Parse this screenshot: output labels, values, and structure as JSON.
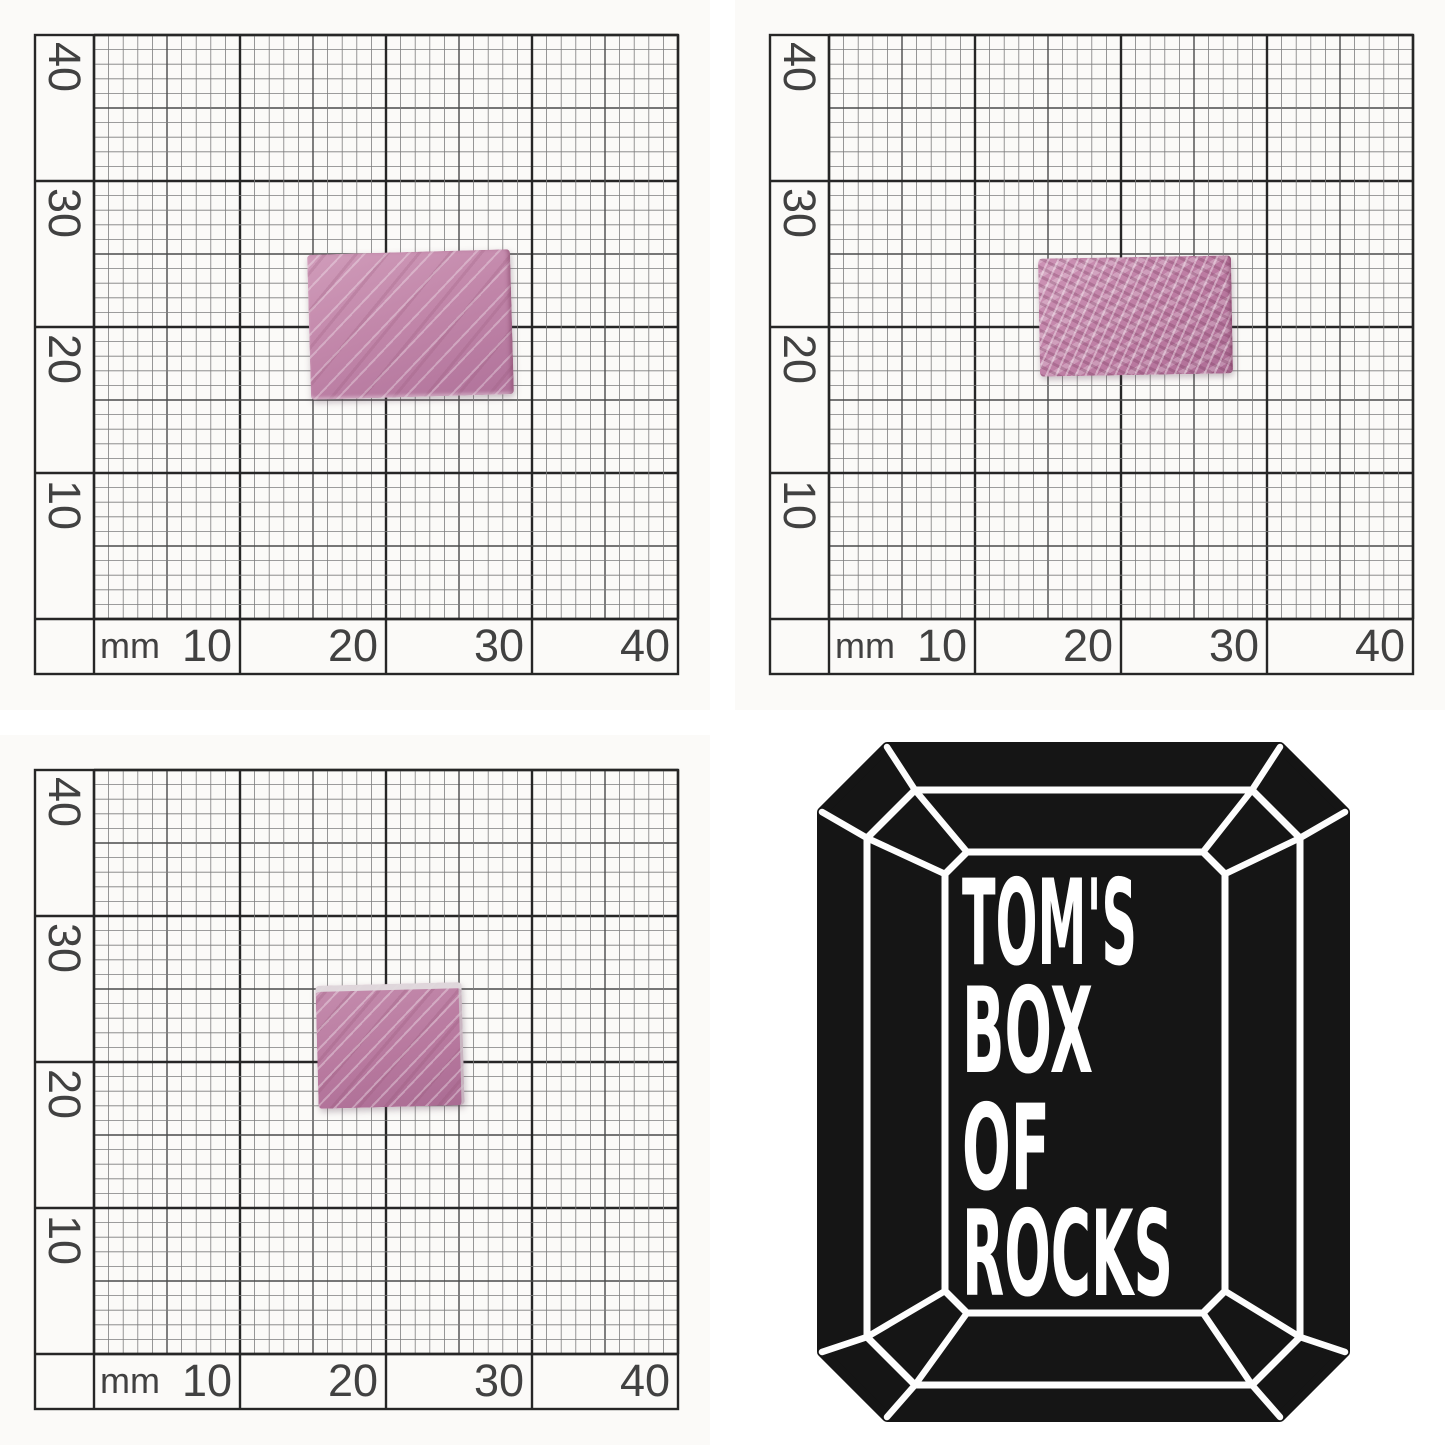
{
  "paper": {
    "unit_label": "mm",
    "y_axis_labels": [
      "40",
      "30",
      "20",
      "10"
    ],
    "x_axis_labels": [
      "10",
      "20",
      "30",
      "40"
    ],
    "paper_color": "#fbfaf8",
    "grid_major_color": "#262626",
    "grid_medium_color": "#4a4a4a",
    "grid_fine_color": "#7d7d7d",
    "label_color": "#414141"
  },
  "specimens": {
    "rock_base_color": "#c287aa",
    "rock_dark_color": "#aa6c93",
    "rock_streak_color": "#e7c6da"
  },
  "logo": {
    "icon": "emerald-cut-gem-icon",
    "lines": [
      "TOM'S",
      "BOX",
      "OF",
      "ROCKS"
    ],
    "gem_color": "#151515",
    "line_color": "#ffffff",
    "text_color": "#ffffff"
  }
}
